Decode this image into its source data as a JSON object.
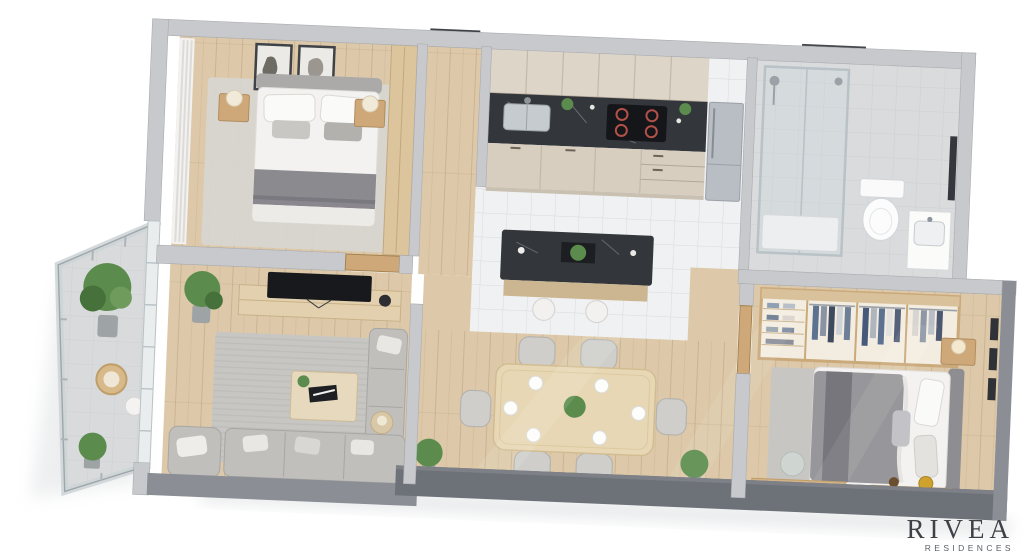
{
  "branding": {
    "name": "RIVEA",
    "tagline": "RESIDENCES"
  },
  "palette": {
    "background": "#ffffff",
    "wall_top": "#c7c9cc",
    "wall_edge": "#a9abaf",
    "wall_mid": "#8b8f95",
    "wall_dark": "#6d7178",
    "floor_wood": "#ddc9a9",
    "floor_tile": "#eff1f2",
    "floor_balcony": "#d8dadb",
    "rug": "#c7c6c3",
    "cabinet": "#d7cec0",
    "counter_marble": "#33363a",
    "steel": "#b9bec4",
    "wood_furniture": "#cfa87a",
    "sofa": "#c0bfbc",
    "bed_linen": "#f3f2f0",
    "duvet_gray": "#97969a",
    "plant_green": "#5c8c4d",
    "glass_line": "#b9c2c7",
    "cooktop_ring": "#b35149",
    "denim_blue": "#5d7291",
    "gold": "#cfa22e",
    "logo_text": "#3e4247"
  },
  "scene": {
    "type": "isometric-3d-floor-plan",
    "style": "photoreal top-down render on white background",
    "rooms": [
      {
        "id": "balcony",
        "furniture": [
          "glass-railing",
          "potted-tree",
          "potted-plant",
          "rattan-chair",
          "side-table"
        ]
      },
      {
        "id": "master-bedroom",
        "furniture": [
          "double-bed",
          "pillows",
          "throw-blanket",
          "nightstand",
          "table-lamp",
          "wall-art",
          "wardrobe",
          "curtains",
          "rug",
          "door"
        ]
      },
      {
        "id": "entry-hall",
        "furniture": [
          "entrance-door"
        ]
      },
      {
        "id": "kitchen",
        "furniture": [
          "upper-cabinets",
          "marble-counter",
          "sink",
          "induction-cooktop",
          "lower-cabinets",
          "refrigerator",
          "island",
          "bar-stools",
          "counter-plants"
        ]
      },
      {
        "id": "bathroom",
        "furniture": [
          "walk-in-shower",
          "shower-head",
          "window",
          "toilet",
          "vanity-sink",
          "mirror"
        ]
      },
      {
        "id": "bedroom-2",
        "furniture": [
          "open-wardrobe",
          "hanging-clothes",
          "shelves",
          "double-bed",
          "duvet",
          "rug",
          "nightstand",
          "table-lamp",
          "desk",
          "desk-chair",
          "laptop",
          "vanity-table",
          "wall-art",
          "door"
        ]
      },
      {
        "id": "living-room",
        "furniture": [
          "tv",
          "tv-stand",
          "potted-plant",
          "rug",
          "coffee-table",
          "books",
          "corner-sofa",
          "armchair",
          "side-table",
          "door"
        ]
      },
      {
        "id": "dining-area",
        "furniture": [
          "dining-table",
          "dining-chairs",
          "place-settings",
          "centerpiece-plant",
          "floor-plants"
        ]
      }
    ]
  }
}
